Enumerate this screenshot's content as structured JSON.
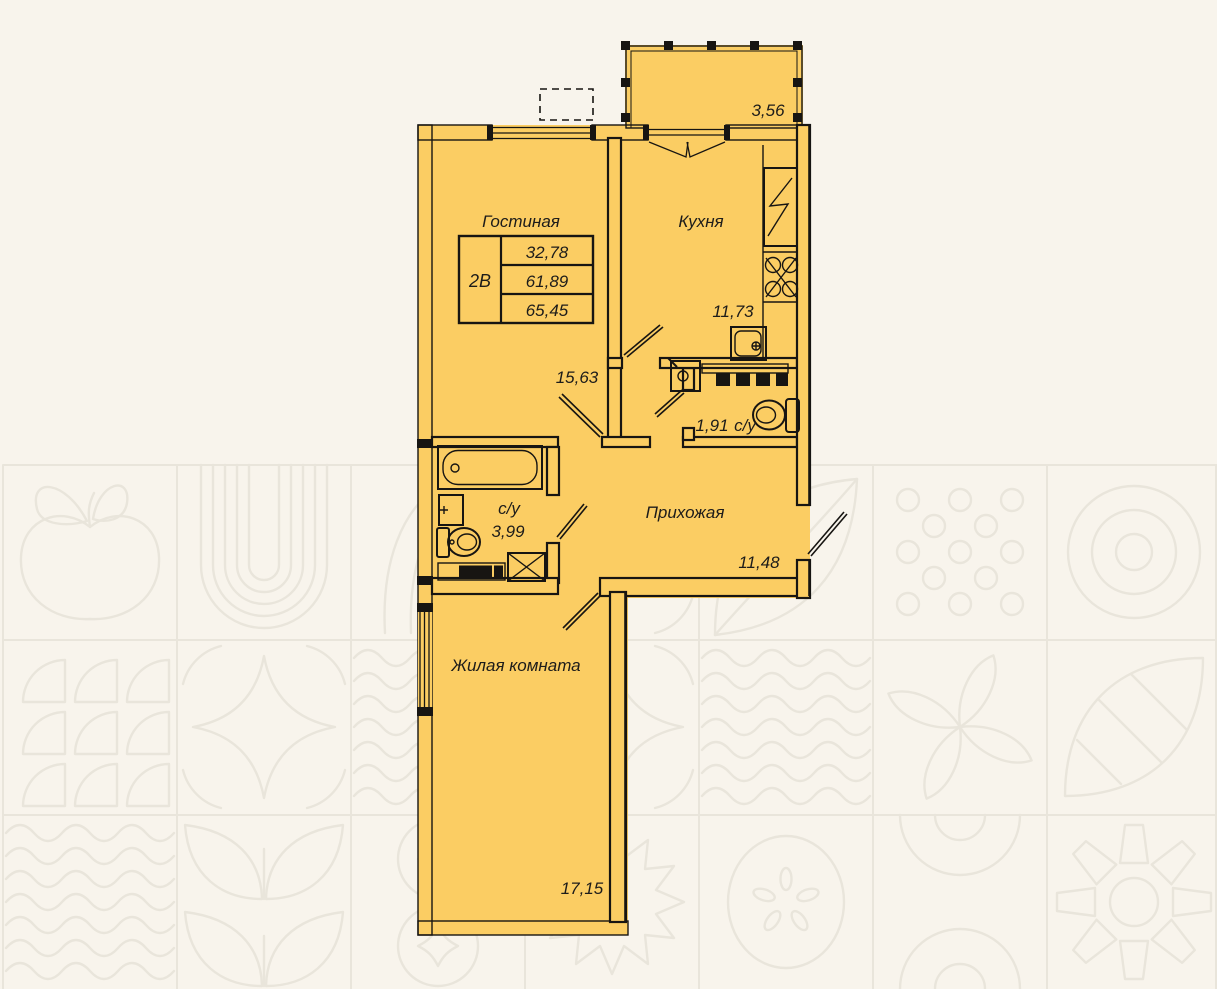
{
  "plan": {
    "unit": {
      "label": "2В"
    },
    "table": {
      "rows": [
        "32,78",
        "61,89",
        "65,45"
      ]
    },
    "rooms": {
      "living": {
        "name": "Гостиная",
        "area": "15,63"
      },
      "kitchen": {
        "name": "Кухня",
        "area": "11,73"
      },
      "wc_small": {
        "name": "с/у",
        "area": "1,91"
      },
      "hall": {
        "name": "Прихожая",
        "area": "11,48"
      },
      "bathroom": {
        "name": "с/у",
        "area": "3,99"
      },
      "bedroom": {
        "name": "Жилая комната",
        "area": "17,15"
      },
      "balcony": {
        "area": "3,56"
      }
    },
    "colors": {
      "room_fill": "#fbcd63",
      "wall": "#171512",
      "background": "#f8f4ec",
      "pattern_line": "#e9e5db",
      "text": "#1d1c1a"
    }
  }
}
